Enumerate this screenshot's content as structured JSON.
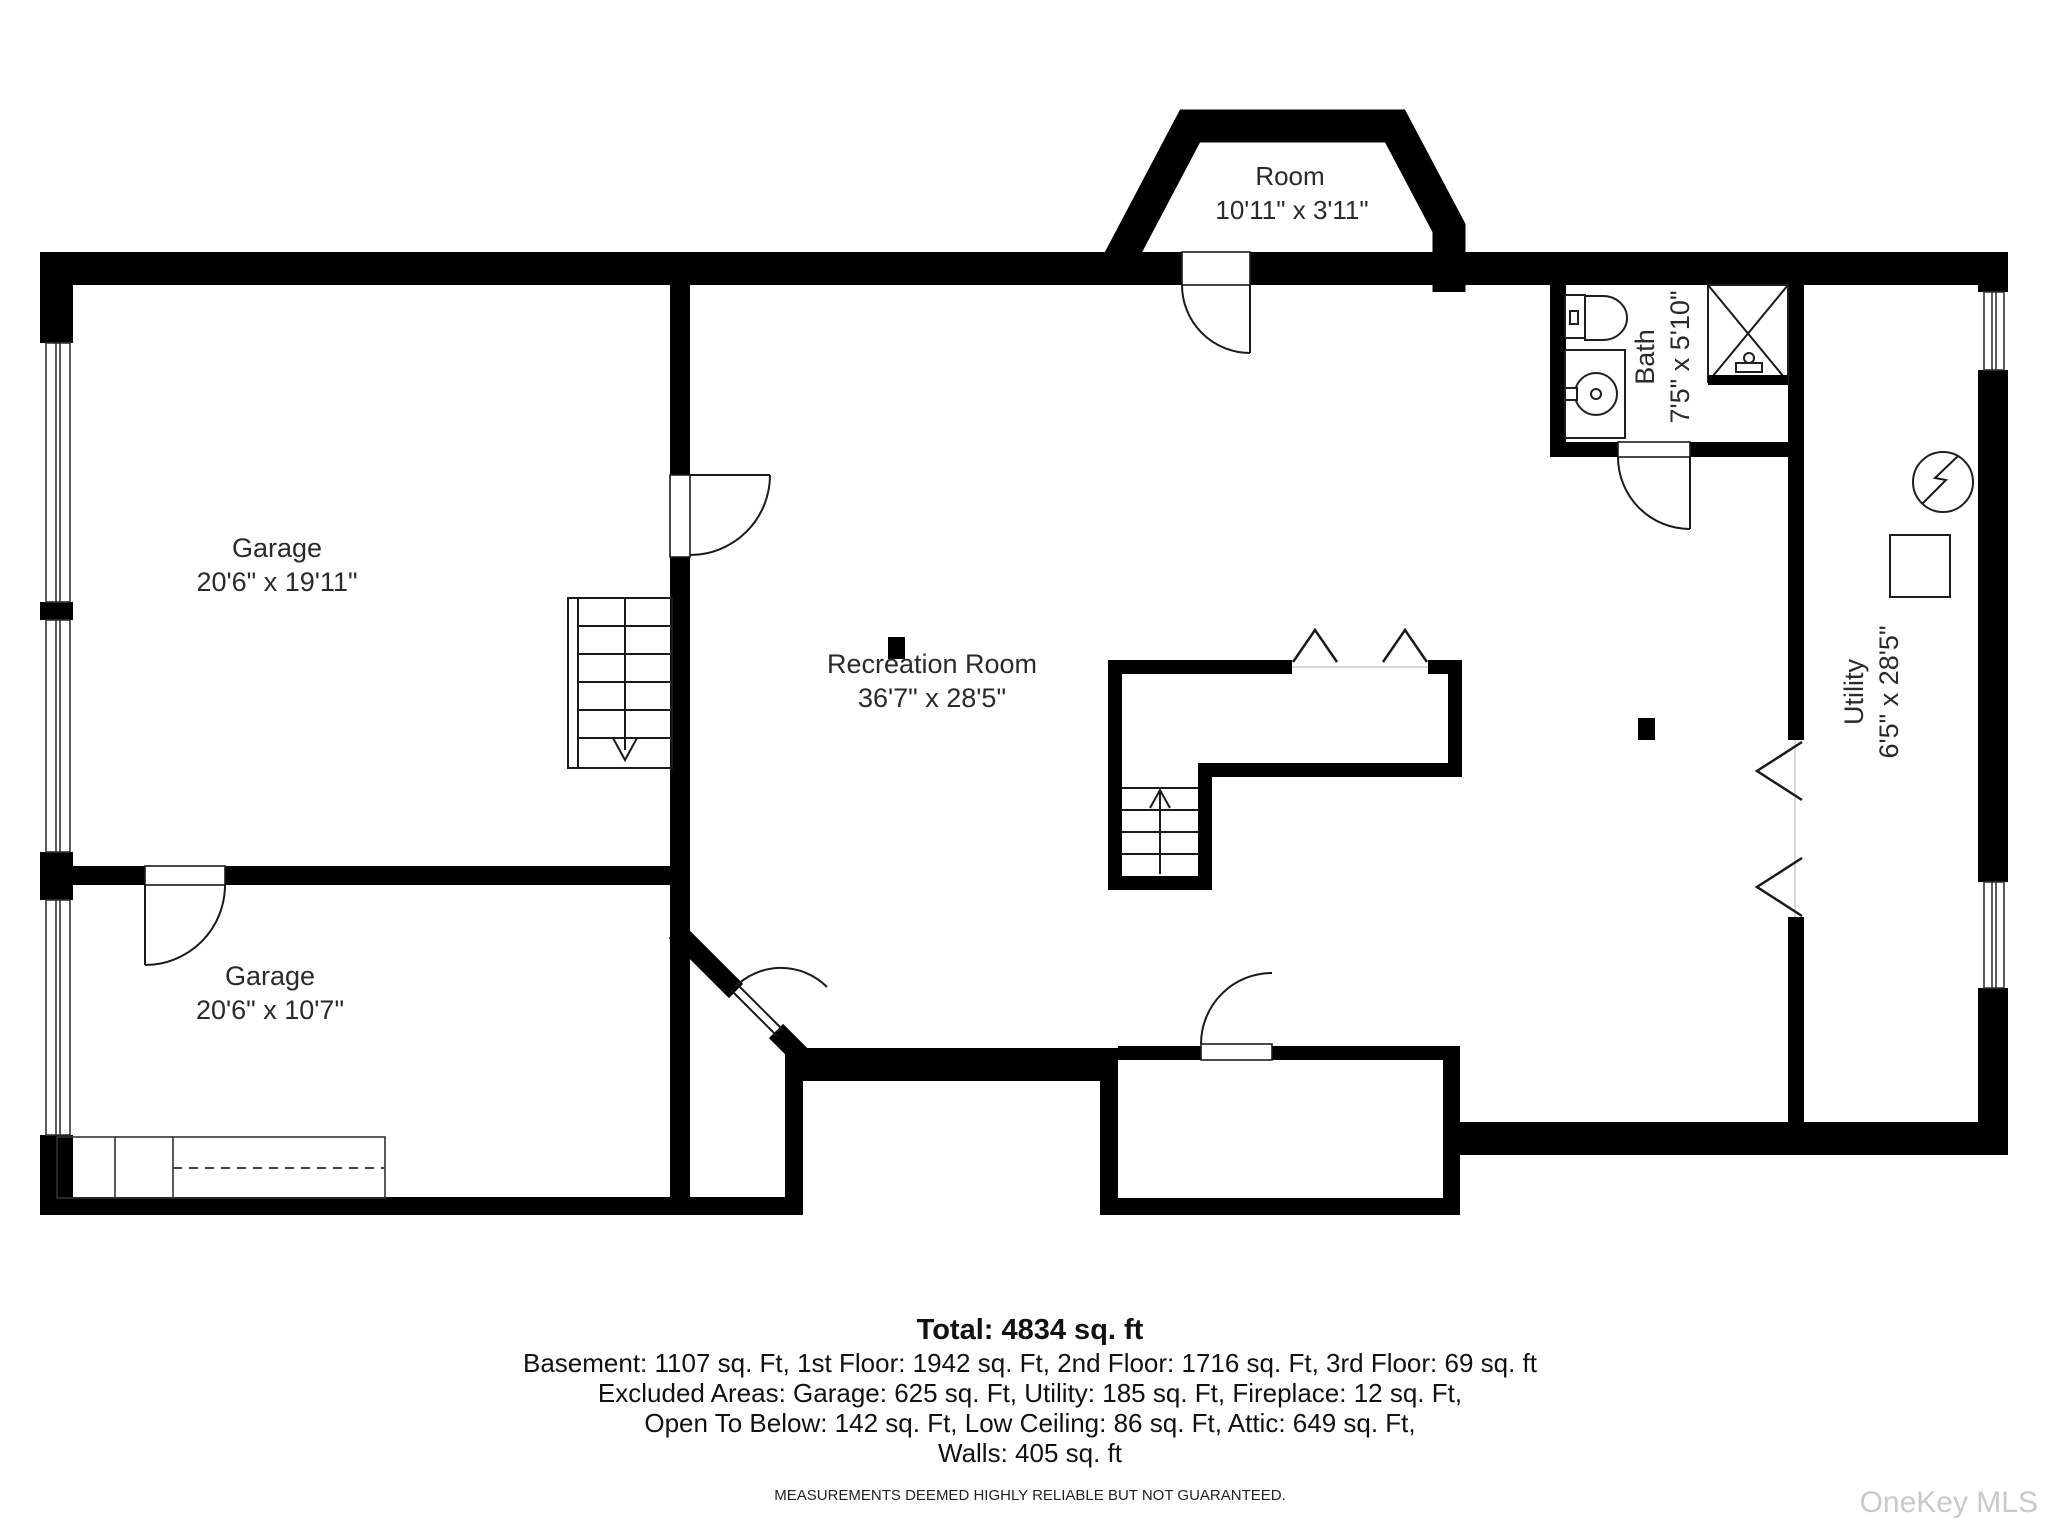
{
  "colors": {
    "walls": "#000000",
    "labels": "#2a2a2a",
    "watermark": "#c9c9c9"
  },
  "plan": {
    "rooms": [
      {
        "id": "garage-upper",
        "name": "Garage",
        "dims": "20'6\" x 19'11\""
      },
      {
        "id": "garage-lower",
        "name": "Garage",
        "dims": "20'6\" x 10'7\""
      },
      {
        "id": "recreation-room",
        "name": "Recreation Room",
        "dims": "36'7\" x 28'5\""
      },
      {
        "id": "bay-room",
        "name": "Room",
        "dims": "10'11\" x 3'11\""
      },
      {
        "id": "bath",
        "name": "Bath",
        "dims": "7'5\" x 5'10\""
      },
      {
        "id": "utility",
        "name": "Utility",
        "dims": "6'5\" x 28'5\""
      }
    ]
  },
  "summary": {
    "total": "Total: 4834 sq. ft",
    "floors": "Basement: 1107 sq. Ft, 1st Floor: 1942 sq. Ft, 2nd Floor: 1716 sq. Ft, 3rd Floor: 69 sq. ft",
    "excluded": "Excluded Areas: Garage: 625 sq. Ft, Utility: 185 sq. Ft, Fireplace: 12 sq. Ft,",
    "excluded2": "Open To Below: 142 sq. Ft, Low Ceiling: 86 sq. Ft, Attic: 649 sq. Ft,",
    "walls": "Walls: 405 sq. ft",
    "disclaimer": "MEASUREMENTS DEEMED HIGHLY RELIABLE BUT NOT GUARANTEED."
  },
  "watermark": "OneKey MLS"
}
